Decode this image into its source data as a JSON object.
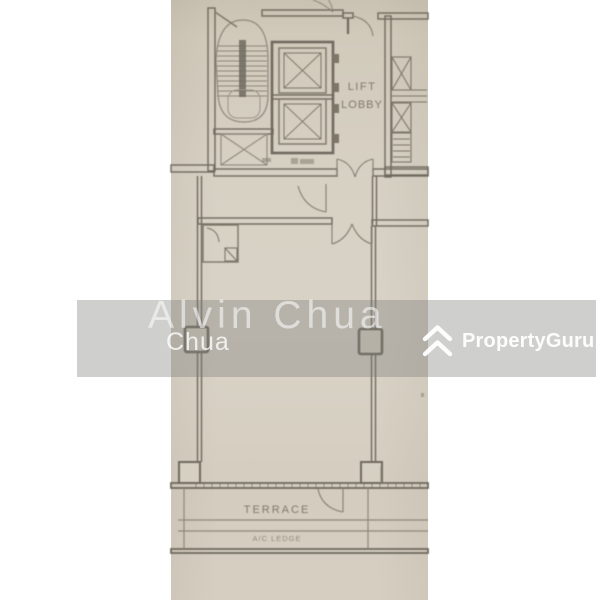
{
  "watermark": {
    "agent_name_large": "Alvin Chua",
    "agent_name_small": "Chua",
    "band_color": "rgba(122,121,119,0.36)",
    "text_color": "#ffffff"
  },
  "brand": {
    "logo_text": "PropertyGuru",
    "logo_color": "#ffffff",
    "logo_icon": "double-chevron-house"
  },
  "floor_plan": {
    "labels": {
      "lift_line1": "LIFT",
      "lift_line2": "LOBBY",
      "terrace": "TERRACE",
      "ac_ledge": "A/C LEDGE"
    },
    "features": [
      "staircase with treads and centre rail",
      "two lift shafts with X car symbols",
      "lift lobby corridor",
      "service shafts with louvres (right edge)",
      "door swing arcs",
      "lower unit room with store/closet",
      "column markers on side walls",
      "terrace strip with a/c ledge"
    ],
    "colors": {
      "paper": "#d7d1c4",
      "wall_line": "#6f6a5e",
      "thin_line": "#8d887a",
      "label_text": "#7f7a6b",
      "page_background": "#ffffff"
    }
  }
}
